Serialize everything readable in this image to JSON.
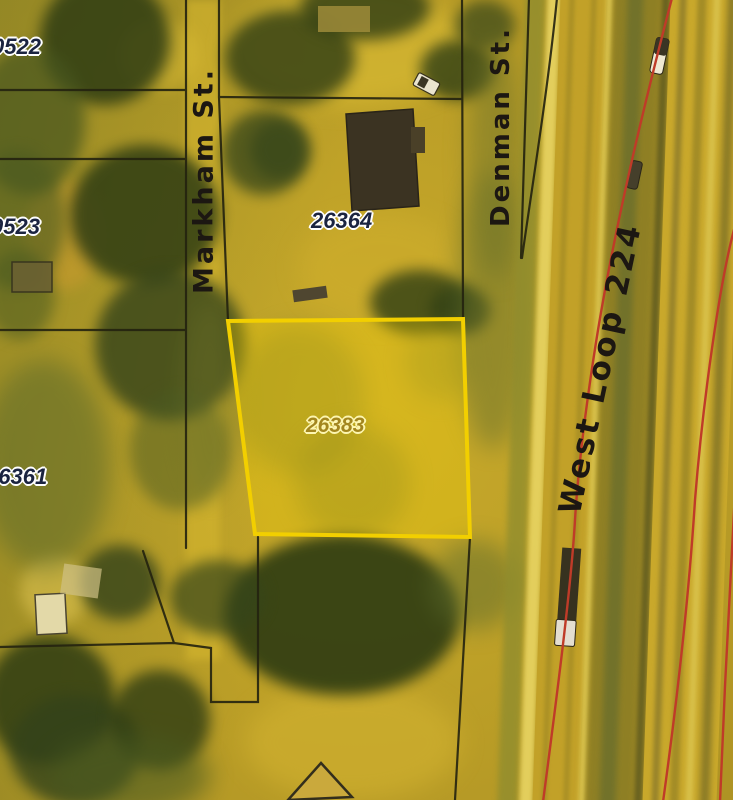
{
  "map": {
    "kind": "scanned aerial parcel map with GIS overlay",
    "labels": {
      "p0522": "0522",
      "p0523": "0523",
      "p26361": "26361",
      "p26364": "26364",
      "p26383": "26383"
    },
    "streets": {
      "markham": "Markham St.",
      "denman": "Denman St.",
      "west_loop": "West Loop 224"
    },
    "highlight": {
      "parcel_id": "26383",
      "border_color": "#f2cf00",
      "fill_color": "rgba(250,215,0,0.28)"
    },
    "colors": {
      "parcel_line": "#23220f",
      "road_marking": "#bf3b28",
      "label_dark": "#1b2440",
      "label_gold": "#a3861e"
    }
  }
}
